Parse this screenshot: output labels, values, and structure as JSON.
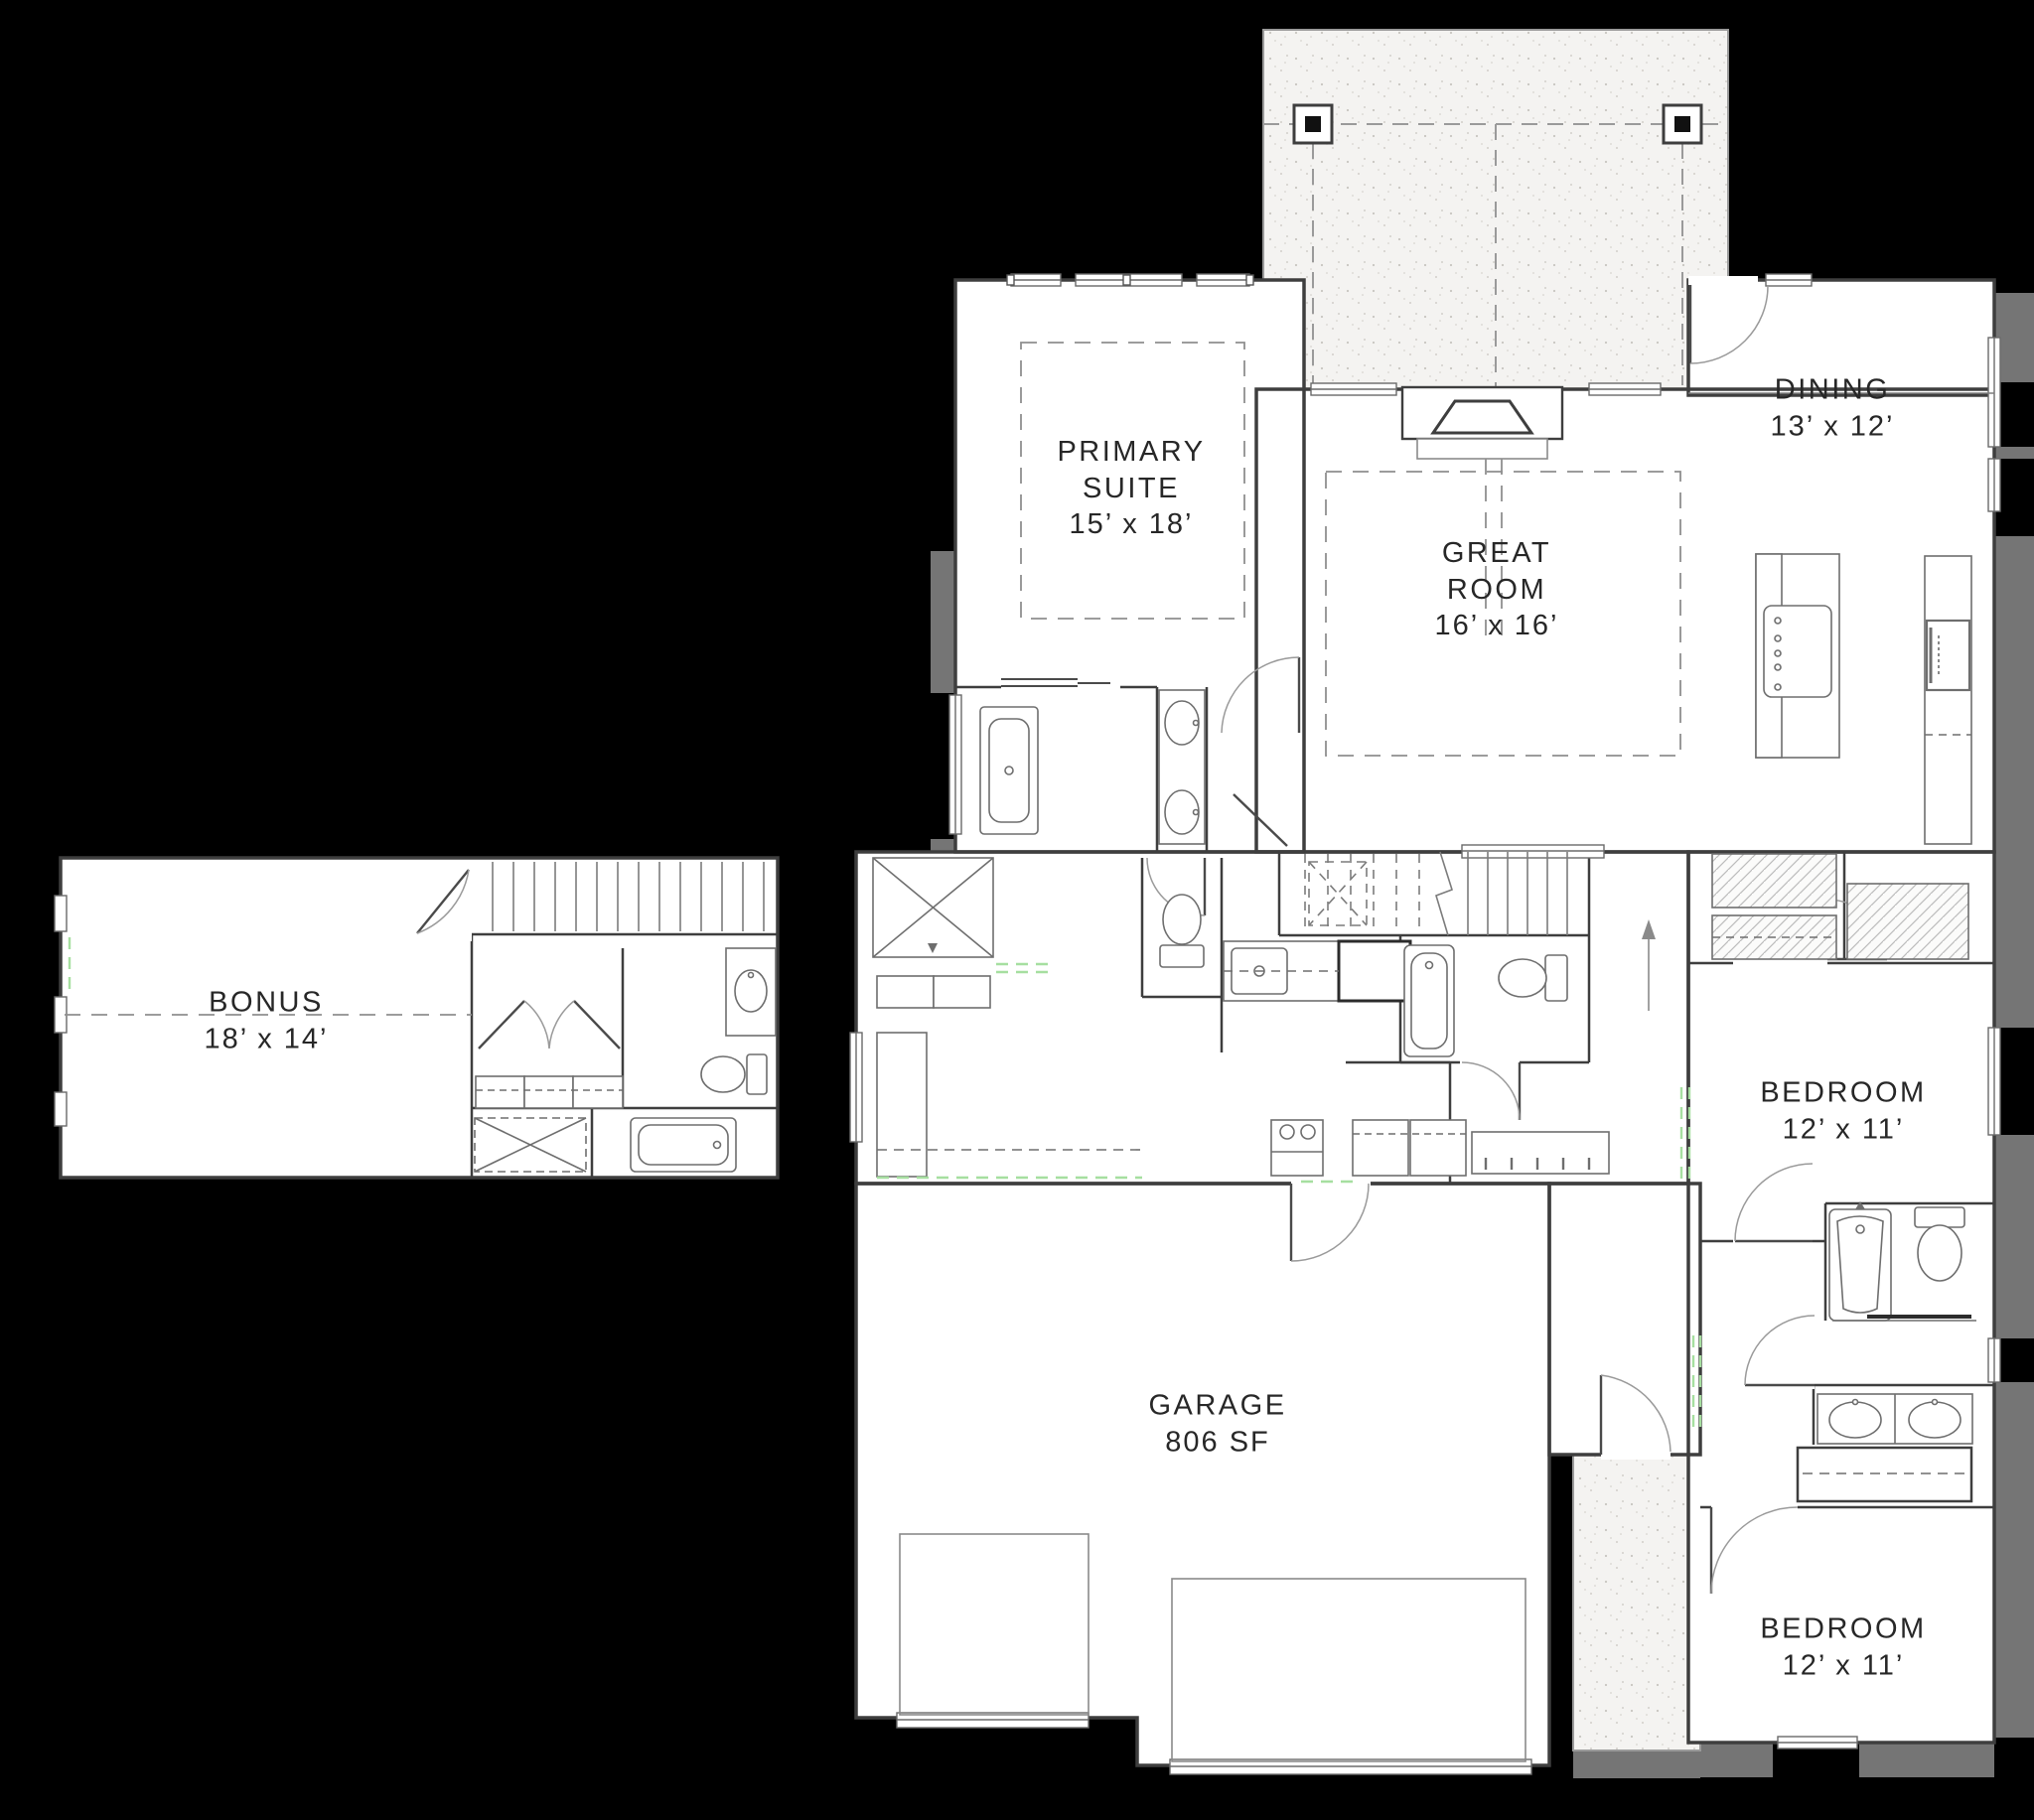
{
  "rooms": {
    "primary_suite": {
      "name": "PRIMARY SUITE",
      "dims": "15’ x 18’"
    },
    "great_room": {
      "name": "GREAT ROOM",
      "dims": "16’ x 16’"
    },
    "dining": {
      "name": "DINING",
      "dims": "13’ x 12’"
    },
    "bonus": {
      "name": "BONUS",
      "dims": "18’ x 14’"
    },
    "bedroom_upper": {
      "name": "BEDROOM",
      "dims": "12’ x 11’"
    },
    "bedroom_lower": {
      "name": "BEDROOM",
      "dims": "12’ x 11’"
    },
    "garage": {
      "name": "GARAGE",
      "dims": "806 SF"
    }
  },
  "colors": {
    "background": "#000000",
    "floor": "#ffffff",
    "patio_fill": "#f4f3f1",
    "wall_line": "#3e3e3e",
    "fixture_line": "#6e6e6e",
    "accent_gray": "#757575",
    "threshold_green": "#a6dfa0",
    "label_text": "#272727"
  }
}
